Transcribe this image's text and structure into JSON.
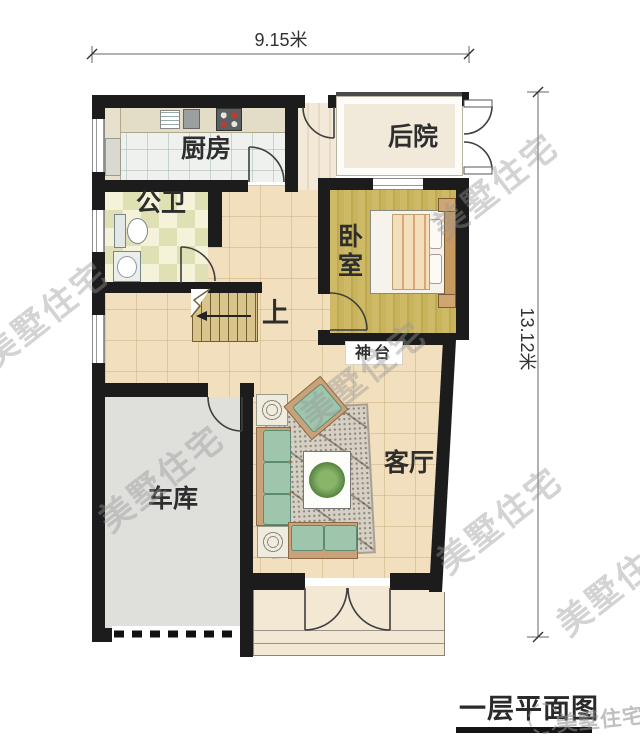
{
  "plan_title": "一层平面图",
  "dimensions": {
    "top": "9.15米",
    "right": "13.12米"
  },
  "rooms": {
    "kitchen": "厨房",
    "backyard": "后院",
    "bathroom": "公卫",
    "bedroom": "卧室",
    "stairs_up": "上",
    "altar": "神台",
    "living_room": "客厅",
    "garage": "车库"
  },
  "watermark": "美墅住宅",
  "colors": {
    "wall": "#1c1c1c",
    "hall_floor": "#f1dfbd",
    "kitchen_floor": "#eef1ee",
    "bedroom_floor": "#c9b45e",
    "bathroom_floor": "#f5f2da",
    "garage_floor": "#dfdfdc",
    "backyard_floor": "#f1e9da",
    "porch_floor": "#f2e8d4",
    "sofa_green": "#9fc6ac",
    "stairs_wood": "#d9c48c"
  }
}
